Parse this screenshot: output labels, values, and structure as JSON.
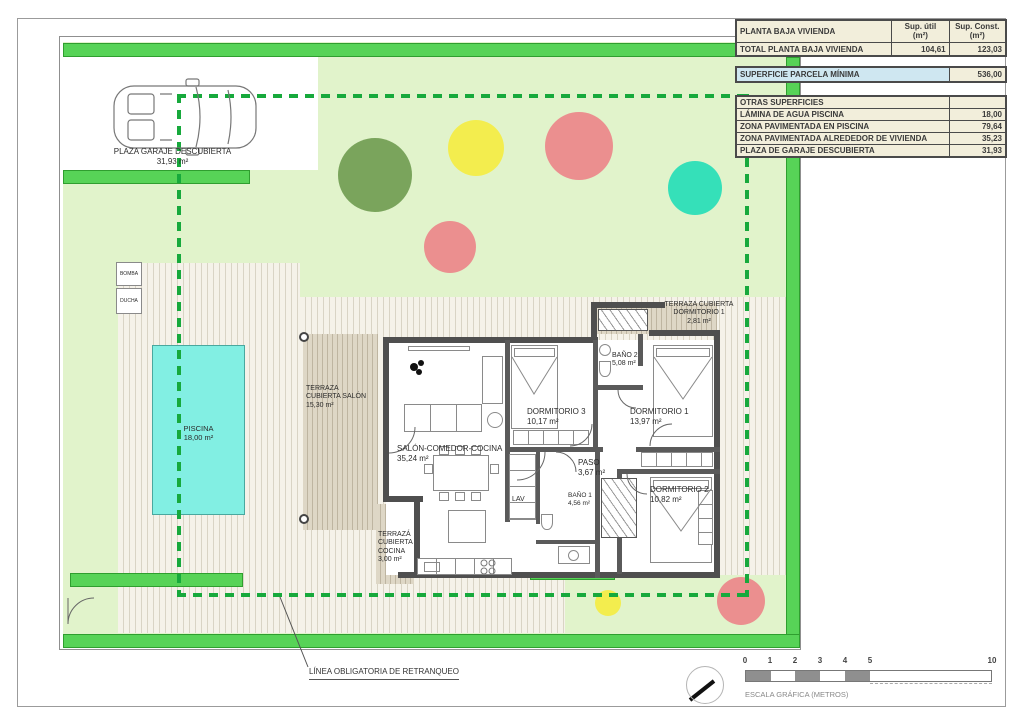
{
  "colors": {
    "band_green": "#57d357",
    "lawn_green": "#e1f3cb",
    "deck_beige": "#f5f2e9",
    "pool_cyan": "#82efe3",
    "setback_green": "#17a93c",
    "wall_gray": "#4f4f4f",
    "table_cream": "#f2eedb",
    "table_blue": "#cfe7f1",
    "tree_dark_green": "#7aa45c",
    "tree_yellow": "#f3ed4e",
    "tree_red": "#eb8f8f",
    "tree_teal": "#35e0b9"
  },
  "tables": {
    "planta": {
      "title": "PLANTA BAJA VIVIENDA",
      "col_util": "Sup. útil\n(m²)",
      "col_const": "Sup. Const.\n(m²)",
      "total_label": "TOTAL PLANTA BAJA VIVIENDA",
      "total_util": "104,61",
      "total_const": "123,03"
    },
    "parcela": {
      "label": "SUPERFICIE PARCELA MÍNIMA",
      "value": "536,00"
    },
    "otras": {
      "title": "OTRAS SUPERFICIES",
      "rows": [
        {
          "label": "LÁMINA DE AGUA PISCINA",
          "value": "18,00"
        },
        {
          "label": "ZONA PAVIMENTADA EN PISCINA",
          "value": "79,64"
        },
        {
          "label": "ZONA PAVIMENTADA ALREDEDOR DE VIVIENDA",
          "value": "35,23"
        },
        {
          "label": "PLAZA DE GARAJE DESCUBIERTA",
          "value": "31,93"
        }
      ]
    }
  },
  "site": {
    "garage": {
      "name": "PLAZA GARAJE DESCUBIERTA",
      "area": "31,93 m²"
    },
    "bomba": "BOMBA",
    "ducha": "DUCHA",
    "piscina": {
      "name": "PISCINA",
      "area": "18,00 m²"
    },
    "terraza_salon": {
      "line1": "TERRAZA",
      "line2": "CUBIERTA SALÓN",
      "area": "15,30 m²"
    },
    "terraza_cocina": {
      "line1": "TERRAZÁ",
      "line2": "CUBIERTA",
      "line3": "COCINA",
      "area": "3,00 m²"
    },
    "terraza_dorm1": {
      "line1": "TERRAZA CUBIERTA",
      "line2": "DORMITORIO 1",
      "area": "2,81 m²"
    },
    "retranqueo": "LÍNEA OBLIGATORIA DE RETRANQUEO"
  },
  "rooms": {
    "salon": {
      "name": "SALÓN-COMEDOR-COCINA",
      "area": "35,24 m²"
    },
    "dorm3": {
      "name": "DORMITORIO 3",
      "area": "10,17 m²"
    },
    "dorm1": {
      "name": "DORMITORIO 1",
      "area": "13,97 m²"
    },
    "dorm2": {
      "name": "DORMITORIO 2",
      "area": "10,82 m²"
    },
    "bano1": {
      "name": "BAÑO 1",
      "area": "4,56 m²"
    },
    "bano2": {
      "name": "BAÑO 2",
      "area": "5,08 m²"
    },
    "paso": {
      "name": "PASO",
      "area": "3,67 m²"
    },
    "lav": "LAV"
  },
  "scalebar": {
    "ticks": [
      "0",
      "1",
      "2",
      "3",
      "4",
      "5",
      "10"
    ],
    "label": "ESCALA GRÁFICA (METROS)"
  }
}
